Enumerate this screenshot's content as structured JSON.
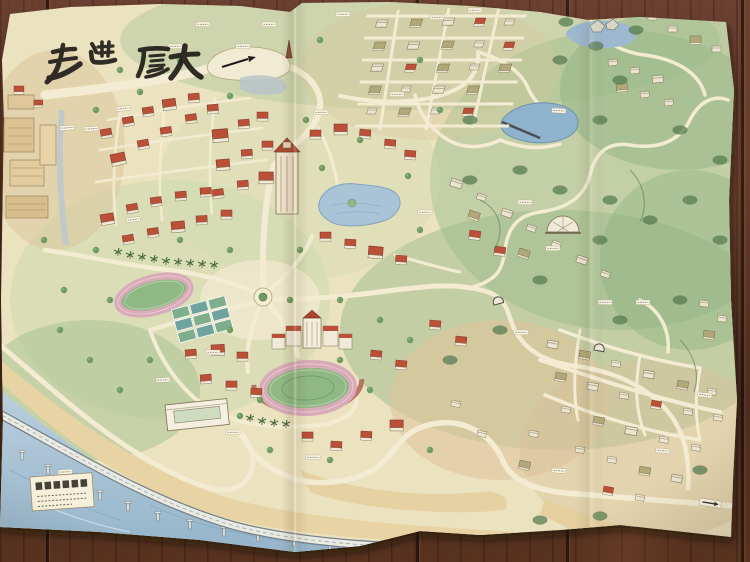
{
  "scene": {
    "type": "photograph",
    "subject": "Hand-drawn watercolor campus map unfolded on a dark wooden table"
  },
  "map": {
    "title": "走进厦大",
    "title_script": "black brush calligraphy across the top left of the map",
    "features": [
      "calligraphy title",
      "dense campus with red-roofed buildings",
      "tall clock tower building",
      "campus lake",
      "central roundabout with radiating roads",
      "running track and sports courts",
      "semicircular stadium below main building row",
      "hillside dormitory clusters",
      "green mountains with winding roads",
      "hill reservoir",
      "rocky pond on summit",
      "coastal elevated bridge on piers",
      "beach and sea",
      "small legend seal box at lower left",
      "tiny white place-name labels (illegible)"
    ],
    "palette": {
      "paper": "#ebe2c0",
      "foliage": "#8fb085",
      "pine": "#4a6c49",
      "roof_red": "#bb4f38",
      "road": "#f3ecd2",
      "sea": "#a7c2d5",
      "beach": "#e7d3a3",
      "ink": "#211d18",
      "wood_table": "#57321f"
    }
  }
}
